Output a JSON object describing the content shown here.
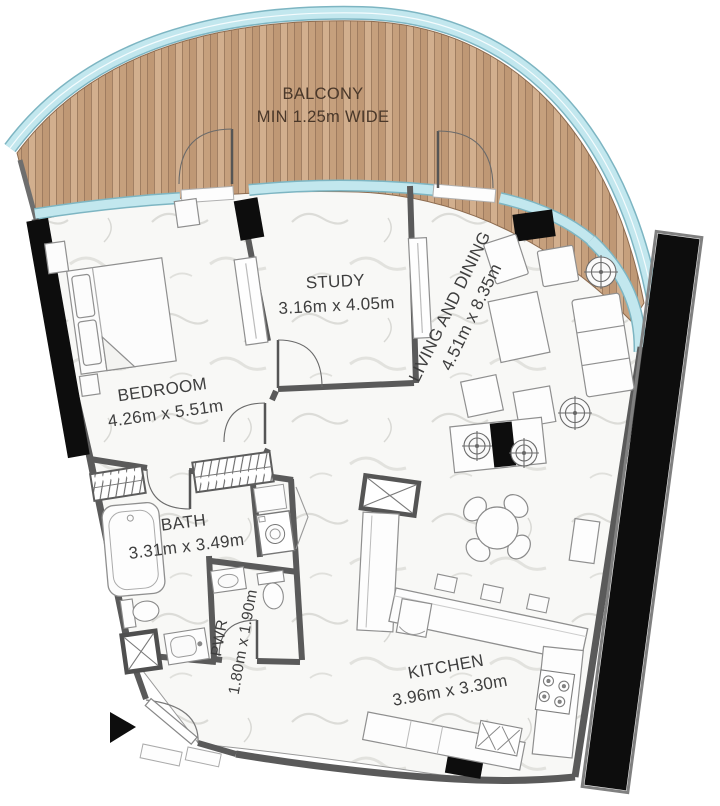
{
  "rooms": {
    "balcony": {
      "name": "BALCONY",
      "dims": "MIN 1.25m WIDE"
    },
    "study": {
      "name": "STUDY",
      "dims": "3.16m x 4.05m"
    },
    "living": {
      "name": "LIVING AND DINING",
      "dims": "4.51m x 8.35m"
    },
    "bedroom": {
      "name": "BEDROOM",
      "dims": "4.26m x 5.51m"
    },
    "bath": {
      "name": "BATH",
      "dims": "3.31m x 3.49m"
    },
    "pwr": {
      "name": "PWR",
      "dims": "1.80m x 1.90m"
    },
    "kitchen": {
      "name": "KITCHEN",
      "dims": "3.96m x 3.30m"
    }
  },
  "colors": {
    "wood": "#c8a382",
    "glass": "#c2e7ee",
    "glass_edge": "#7db5c2",
    "wall": "#5a5a5a",
    "column": "#0d0d0d",
    "floor": "#f8f8f6",
    "text": "#3e3e3e",
    "balcony_text": "#4a382a"
  }
}
